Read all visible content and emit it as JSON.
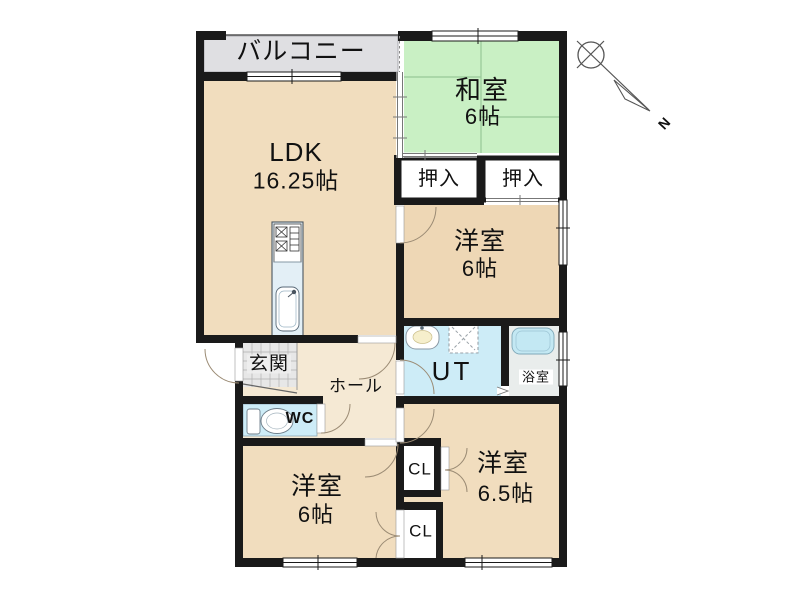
{
  "plan_type": "apartment-floor-plan",
  "labels": {
    "balcony": "バルコニー",
    "ldk": "LDK",
    "ldk_area": "16.25帖",
    "washitsu": "和室",
    "washitsu_area": "6帖",
    "oshiire_left": "押入",
    "oshiire_right": "押入",
    "yoshitsu_mid": "洋室",
    "yoshitsu_mid_area": "6帖",
    "ut": "UT",
    "bath": "浴室",
    "genkan": "玄関",
    "hall": "ホール",
    "wc": "WC",
    "yoshitsu_bl": "洋室",
    "yoshitsu_bl_area": "6帖",
    "cl_top": "CL",
    "cl_bottom": "CL",
    "yoshitsu_br": "洋室",
    "yoshitsu_br_area": "6.5帖",
    "compass_n": "N"
  },
  "rooms": [
    {
      "name": "バルコニー",
      "size": ""
    },
    {
      "name": "LDK",
      "size": "16.25帖"
    },
    {
      "name": "和室",
      "size": "6帖"
    },
    {
      "name": "押入",
      "size": ""
    },
    {
      "name": "押入",
      "size": ""
    },
    {
      "name": "洋室",
      "size": "6帖"
    },
    {
      "name": "UT",
      "size": ""
    },
    {
      "name": "浴室",
      "size": ""
    },
    {
      "name": "玄関",
      "size": ""
    },
    {
      "name": "ホール",
      "size": ""
    },
    {
      "name": "WC",
      "size": ""
    },
    {
      "name": "洋室",
      "size": "6帖"
    },
    {
      "name": "CL",
      "size": ""
    },
    {
      "name": "CL",
      "size": ""
    },
    {
      "name": "洋室",
      "size": "6.5帖"
    }
  ],
  "colors": {
    "wall": "#1a1a1a",
    "room_beige": "#f1ddbe",
    "room_beige_dark": "#eed7b5",
    "hall_beige": "#f5e9d4",
    "tatami_green": "#c9f0c4",
    "tatami_line": "#98c898",
    "balcony_gray": "#dfdfe2",
    "water_blue": "#cdecf7",
    "bath_floor": "#e9edec",
    "tub_blue": "#c3e8f3",
    "tile_gray": "#e7e7e7",
    "counter_blue": "#e3eff6",
    "box_white": "#ffffff"
  }
}
